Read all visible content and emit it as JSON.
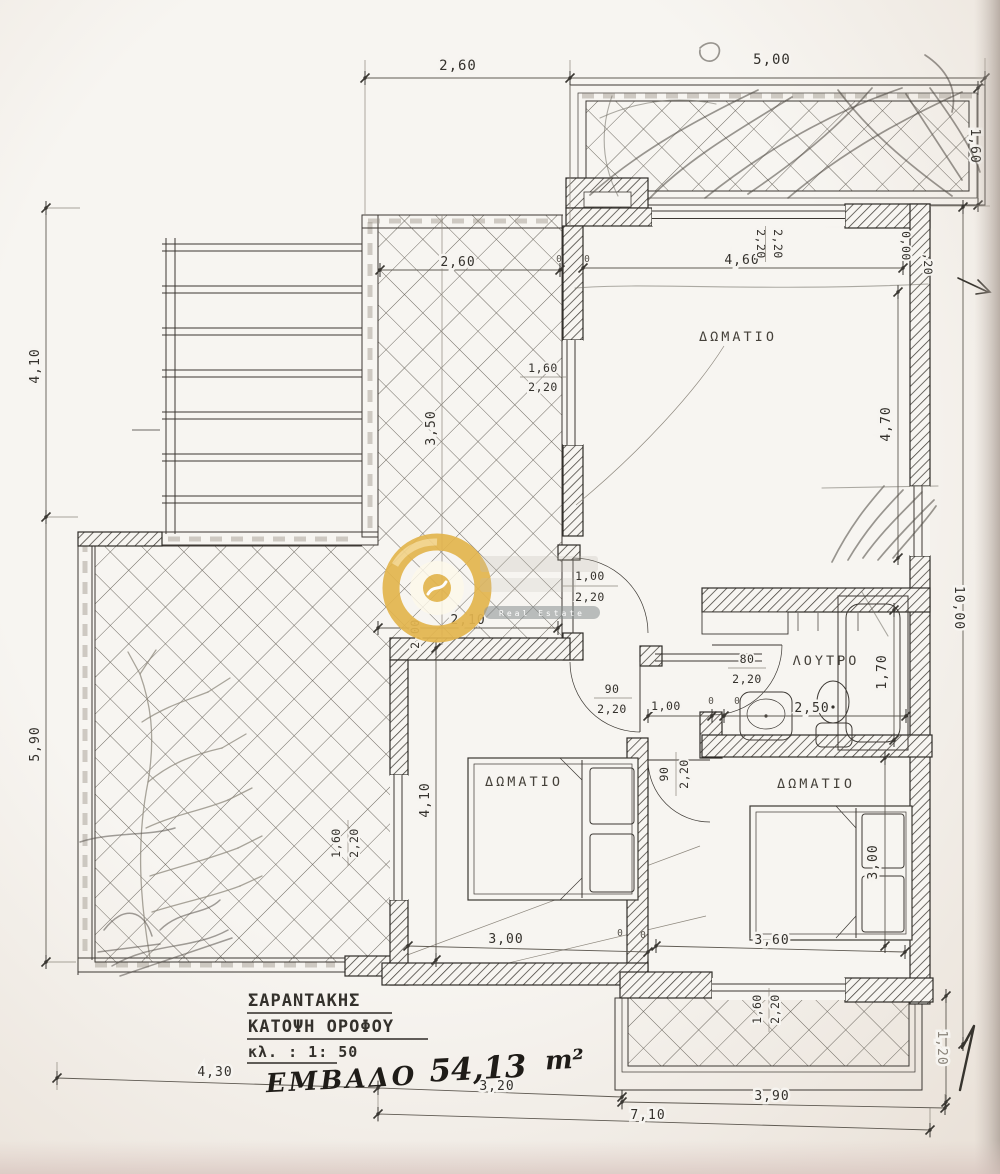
{
  "drawing": {
    "title_block": {
      "name": "ΣΑΡΑΝΤΑΚΗΣ",
      "drawing": "ΚΑΤΟΨΗ ΟΡΟΦΟΥ",
      "scale": "κλ. : 1: 50",
      "area_label": "ΕΜΒΑΔΟ",
      "area_value": "54,13",
      "area_unit": "m²"
    },
    "rooms": {
      "room1": "ΔΩΜΑΤΙΟ",
      "room2": "ΔΩΜΑΤΙΟ",
      "room3": "ΔΩΜΑΤΙΟ",
      "bath": "ΛΟΥΤΡΟ"
    },
    "dims": {
      "top_left": "2,60",
      "top_right": "5,00",
      "right_balcony": "1,60",
      "right_overall": "10,00",
      "right_lower": "1,20",
      "left_upper": "4,10",
      "left_lower": "5,90",
      "bottom_a": "4,30",
      "bottom_b": "3,20",
      "bottom_c": "3,90",
      "bottom_d": "7,10",
      "room1_w": "4,60",
      "room1_h": "4,70",
      "terrace_w": "2,60",
      "terrace_h": "3,50",
      "terrace_b": "2,00",
      "hall_w": "2,10",
      "corridor": "1,00",
      "room2_h": "4,10",
      "room2_w": "3,00",
      "room3_w": "3,60",
      "room3_h": "3,00",
      "bath_w": "2,50",
      "tub_l": "1,70",
      "level_zero": "0,00",
      "level_twenty": ",20",
      "zero": "0"
    },
    "openings": {
      "win_room1_a": "2,20",
      "win_room1_b": "2,20",
      "win_terrace_n": "1,60",
      "win_terrace_d": "2,20",
      "door_entry_n": "1,00",
      "door_entry_d": "2,20",
      "door_room2_n": "90",
      "door_room2_d": "2,20",
      "door_bath_n": "80",
      "door_bath_d": "2,20",
      "door_room3_n": "90",
      "door_room3_d": "2,20",
      "win_room2_n": "1,60",
      "win_room2_d": "2,20",
      "win_room3_n": "1,60",
      "win_room3_d": "2,20"
    },
    "watermark": {
      "brand": "Real Estate"
    }
  }
}
